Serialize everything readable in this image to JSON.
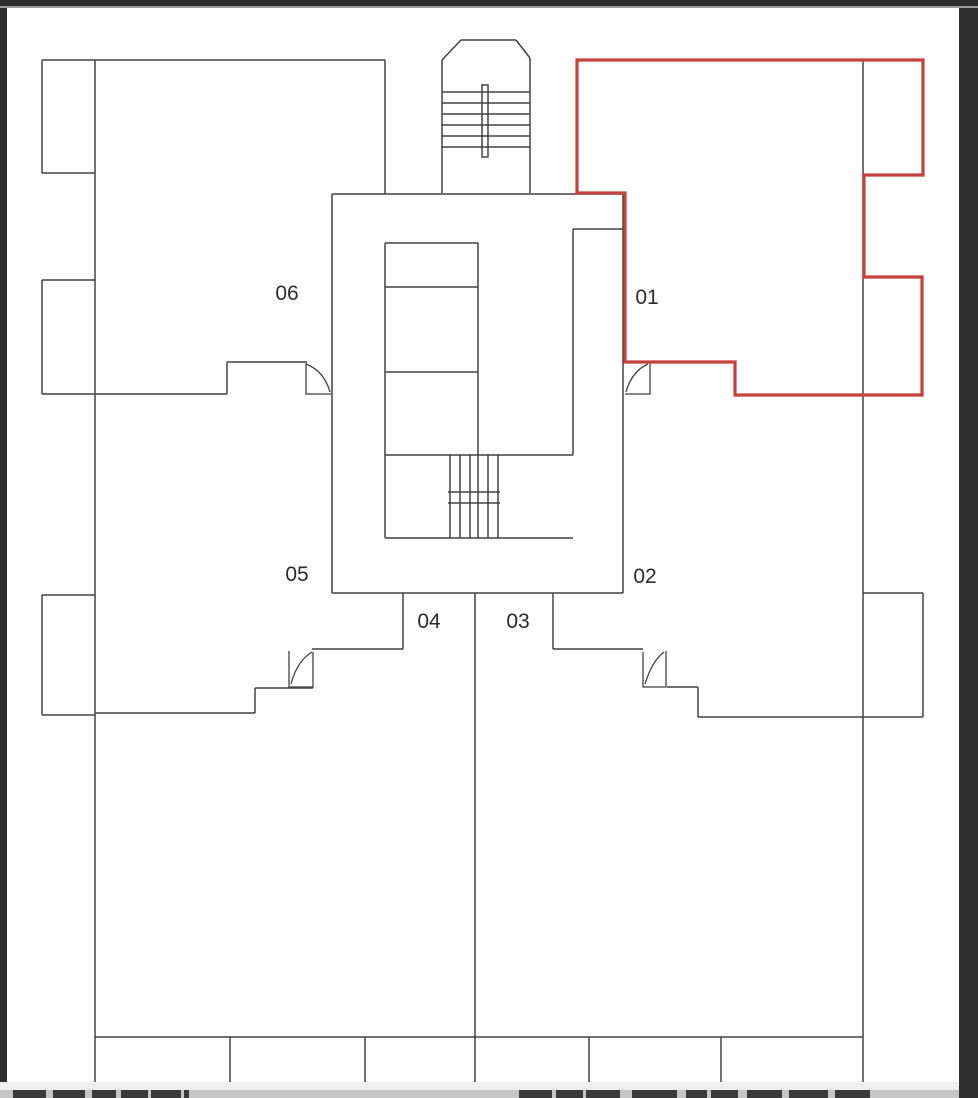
{
  "window": {
    "frame_color": "#2e2e2e",
    "frame_top_accent": "#9a9a9a",
    "page_bg": "#ffffff"
  },
  "floorplan": {
    "wall_color": "#424242",
    "label_color": "#2b2b2b",
    "highlight": {
      "color": "#c5413c",
      "unit": "01",
      "outline_points": "577,60 923,60 923,175 864,175 864,277 922,277 922,395 735,395 735,362 625,362 625,193 577,193"
    },
    "units": [
      {
        "label": "01",
        "x": 647,
        "y": 304,
        "highlighted": true
      },
      {
        "label": "02",
        "x": 645,
        "y": 583,
        "highlighted": false
      },
      {
        "label": "03",
        "x": 518,
        "y": 628,
        "highlighted": false
      },
      {
        "label": "04",
        "x": 429,
        "y": 628,
        "highlighted": false
      },
      {
        "label": "05",
        "x": 297,
        "y": 581,
        "highlighted": false
      },
      {
        "label": "06",
        "x": 287,
        "y": 300,
        "highlighted": false
      }
    ],
    "walls": [
      [
        42,
        60,
        385,
        60
      ],
      [
        42,
        60,
        42,
        173
      ],
      [
        42,
        173,
        95,
        173
      ],
      [
        95,
        60,
        95,
        1084
      ],
      [
        385,
        60,
        385,
        194
      ],
      [
        42,
        280,
        95,
        280
      ],
      [
        42,
        280,
        42,
        394
      ],
      [
        42,
        394,
        227,
        394
      ],
      [
        227,
        362,
        227,
        394
      ],
      [
        227,
        362,
        307,
        362
      ],
      [
        42,
        595,
        95,
        595
      ],
      [
        42,
        595,
        42,
        715
      ],
      [
        42,
        715,
        95,
        715
      ],
      [
        95,
        713,
        255,
        713
      ],
      [
        255,
        688,
        255,
        713
      ],
      [
        255,
        688,
        313,
        688
      ],
      [
        312,
        649,
        403,
        649
      ],
      [
        403,
        593,
        403,
        649
      ],
      [
        332,
        194,
        623,
        194
      ],
      [
        332,
        194,
        332,
        593
      ],
      [
        623,
        194,
        623,
        593
      ],
      [
        332,
        593,
        623,
        593
      ],
      [
        385,
        243,
        478,
        243
      ],
      [
        385,
        243,
        385,
        538
      ],
      [
        478,
        243,
        478,
        538
      ],
      [
        385,
        287,
        478,
        287
      ],
      [
        385,
        372,
        478,
        372
      ],
      [
        385,
        455,
        573,
        455
      ],
      [
        385,
        538,
        573,
        538
      ],
      [
        573,
        229,
        573,
        455
      ],
      [
        573,
        229,
        623,
        229
      ],
      [
        450,
        455,
        450,
        538
      ],
      [
        460,
        455,
        460,
        538
      ],
      [
        470,
        455,
        470,
        538
      ],
      [
        488,
        455,
        488,
        538
      ],
      [
        498,
        455,
        498,
        538
      ],
      [
        448,
        492,
        500,
        492
      ],
      [
        448,
        503,
        500,
        503
      ],
      [
        442,
        60,
        442,
        193
      ],
      [
        530,
        58,
        530,
        193
      ],
      [
        442,
        60,
        461,
        40
      ],
      [
        461,
        40,
        516,
        40
      ],
      [
        516,
        40,
        530,
        58
      ],
      [
        442,
        92,
        530,
        92
      ],
      [
        442,
        103,
        530,
        103
      ],
      [
        442,
        114,
        530,
        114
      ],
      [
        442,
        125,
        530,
        125
      ],
      [
        442,
        136,
        530,
        136
      ],
      [
        442,
        147,
        530,
        147
      ],
      [
        553,
        593,
        553,
        649
      ],
      [
        553,
        649,
        643,
        649
      ],
      [
        667,
        687,
        698,
        687
      ],
      [
        698,
        687,
        698,
        717
      ],
      [
        698,
        717,
        923,
        717
      ],
      [
        863,
        593,
        923,
        593
      ],
      [
        923,
        593,
        923,
        717
      ],
      [
        863,
        60,
        863,
        1084
      ],
      [
        475,
        593,
        475,
        1037
      ],
      [
        95,
        1037,
        863,
        1037
      ],
      [
        230,
        1037,
        230,
        1084
      ],
      [
        365,
        1037,
        365,
        1084
      ],
      [
        475,
        1037,
        475,
        1084
      ],
      [
        589,
        1037,
        589,
        1084
      ],
      [
        721,
        1037,
        721,
        1084
      ]
    ],
    "stair_rail_rect": [
      482,
      85,
      6,
      72
    ],
    "doors": [
      {
        "edges": "M306,363 L306,394 L331,394",
        "leaf": "M306,364 Q324,371 330,392"
      },
      {
        "edges": "M650,363 L650,394 L625,394",
        "leaf": "M648,364 Q632,371 626,392"
      },
      {
        "edges": "M289,651 L289,687 L313,687 L313,652",
        "leaf": "M291,684 Q297,661 312,652"
      },
      {
        "edges": "M666,651 L666,687 L643,687 L643,652",
        "leaf": "M645,684 Q652,661 664,652"
      }
    ]
  },
  "caption": {
    "strip_bg": "#efefef",
    "bar_bg": "#c6c6c6",
    "glyph_color": "#3a3a3a",
    "left_fragments": [
      [
        13,
        33
      ],
      [
        53,
        32
      ],
      [
        92,
        24
      ],
      [
        121,
        27
      ],
      [
        151,
        30
      ],
      [
        184,
        5
      ]
    ],
    "right_fragments": [
      [
        519,
        33
      ],
      [
        556,
        27
      ],
      [
        586,
        34
      ],
      [
        632,
        45
      ],
      [
        686,
        21
      ],
      [
        711,
        27
      ],
      [
        747,
        35
      ],
      [
        789,
        39
      ],
      [
        835,
        35
      ]
    ]
  }
}
